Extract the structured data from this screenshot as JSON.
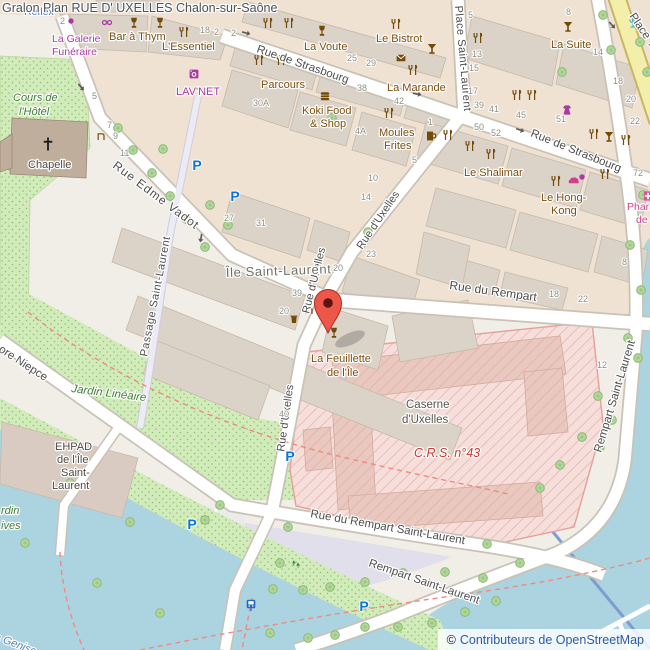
{
  "header": {
    "title": "Gralon Plan RUE D' UXELLES Chalon-sur-Saône"
  },
  "attribution": {
    "copyright": "©",
    "text": "Contributeurs de OpenStreetMap"
  },
  "colors": {
    "water": "#abd4e0",
    "park_green": "#d2ebbb",
    "military_fill": "#f6dedb",
    "military_border": "#e5a09a",
    "building": "#dbd2c8",
    "primary_road": "#f4eeab",
    "pedestrian_area": "#e0dfeb",
    "marker": "#ed574a",
    "parking_blue": "#0d74d6",
    "poi_brown": "#7a4e0e",
    "poi_purple": "#ab39a4",
    "attribution_blue": "#2d59a8"
  },
  "map": {
    "marker": {
      "x": 328,
      "y": 303,
      "color": "#ed574a"
    },
    "labels": [
      {
        "t": "Rue de Strasbourg",
        "x": 256,
        "y": 52,
        "r": 19,
        "c": "st"
      },
      {
        "t": "Rue de Strasbourg",
        "x": 530,
        "y": 136,
        "r": 22,
        "c": "st"
      },
      {
        "t": "Rue du Rempart",
        "x": 449,
        "y": 289,
        "r": 8,
        "c": "st",
        "fs": 12
      },
      {
        "t": "Rue du Rempart Saint-Laurent",
        "x": 310,
        "y": 517,
        "r": 10,
        "c": "st"
      },
      {
        "t": "Rempart Saint-Laurent",
        "x": 368,
        "y": 566,
        "r": 19,
        "c": "st"
      },
      {
        "t": "Rempart Saint-Laurent",
        "x": 601,
        "y": 453,
        "r": -73,
        "c": "st"
      },
      {
        "t": "Rue d'Uxelles",
        "x": 362,
        "y": 250,
        "r": -56,
        "c": "st",
        "fs": 11
      },
      {
        "t": "Rue d'Uxelles",
        "x": 309,
        "y": 314,
        "r": -76,
        "c": "st",
        "fs": 11
      },
      {
        "t": "Rue d'Uxelles",
        "x": 284,
        "y": 452,
        "r": -82,
        "c": "st",
        "fs": 11
      },
      {
        "t": "Rue Edme Vadot",
        "x": 112,
        "y": 167,
        "r": 37,
        "c": "st",
        "fs": 12,
        "ls": 1
      },
      {
        "t": "Passage Saint-Laurent",
        "x": 147,
        "y": 357,
        "r": -79,
        "c": "st",
        "fs": 11,
        "ls": 0.5
      },
      {
        "t": "Place Saint-Laurent",
        "x": 455,
        "y": 6,
        "r": 85,
        "c": "st",
        "fs": 11,
        "ls": 0.5
      },
      {
        "t": "Place Thev",
        "x": 629,
        "y": 16,
        "r": 56,
        "c": "st",
        "fs": 11.5
      },
      {
        "t": "ore Niepce",
        "x": -2,
        "y": 351,
        "r": 33,
        "c": "st",
        "fs": 11.5
      },
      {
        "t": "Île Saint-Laurent",
        "x": 226,
        "y": 277,
        "r": -2,
        "c": "pl"
      },
      {
        "t": "Cours de",
        "x": 13,
        "y": 101,
        "c": "pk"
      },
      {
        "t": "l'Hôtel",
        "x": 19,
        "y": 115,
        "c": "pk"
      },
      {
        "t": "Jardin Linéaire",
        "x": 71,
        "y": 392,
        "r": 7,
        "c": "pk",
        "fs": 11.5
      },
      {
        "t": "rdin",
        "x": 1,
        "y": 514,
        "c": "pk"
      },
      {
        "t": "ives",
        "x": 1,
        "y": 529,
        "c": "pk"
      },
      {
        "t": "La Genise",
        "x": -12,
        "y": 637,
        "r": 21,
        "c": "wt"
      },
      {
        "t": "Reflex",
        "x": 24,
        "y": 15,
        "c": "bl"
      },
      {
        "t": "La Galerie",
        "x": 52,
        "y": 42,
        "c": "pu"
      },
      {
        "t": "Funéraire",
        "x": 52,
        "y": 55,
        "c": "pu"
      },
      {
        "t": "LAV'NET",
        "x": 176,
        "y": 95,
        "c": "pu",
        "fs": 11
      },
      {
        "t": "Bar à Thym",
        "x": 109,
        "y": 40,
        "c": "br",
        "fs": 11
      },
      {
        "t": "L'Essentiel",
        "x": 162,
        "y": 50,
        "c": "br",
        "fs": 11
      },
      {
        "t": "La Voute",
        "x": 304,
        "y": 50,
        "c": "br",
        "fs": 11
      },
      {
        "t": "Le Bistrot",
        "x": 376,
        "y": 42,
        "c": "br",
        "fs": 11
      },
      {
        "t": "Parcours",
        "x": 261,
        "y": 88,
        "c": "br",
        "fs": 11
      },
      {
        "t": "La Marande",
        "x": 387,
        "y": 91,
        "c": "br",
        "fs": 11
      },
      {
        "t": "Koki Food",
        "x": 302,
        "y": 114,
        "c": "br",
        "fs": 11
      },
      {
        "t": "& Shop",
        "x": 310,
        "y": 127,
        "c": "br",
        "fs": 11
      },
      {
        "t": "Moules",
        "x": 379,
        "y": 136,
        "c": "br",
        "fs": 11
      },
      {
        "t": "Frites",
        "x": 384,
        "y": 149,
        "c": "br",
        "fs": 11
      },
      {
        "t": "Le Shalimar",
        "x": 464,
        "y": 176,
        "c": "br",
        "fs": 11
      },
      {
        "t": "Le Hong-",
        "x": 541,
        "y": 201,
        "c": "br",
        "fs": 11
      },
      {
        "t": "Kong",
        "x": 551,
        "y": 214,
        "c": "br",
        "fs": 11
      },
      {
        "t": "La Suite",
        "x": 551,
        "y": 48,
        "c": "br",
        "fs": 11
      },
      {
        "t": "La Feuillette",
        "x": 311,
        "y": 362,
        "c": "br",
        "fs": 11
      },
      {
        "t": "de l'Île",
        "x": 327,
        "y": 376,
        "c": "br",
        "fs": 11
      },
      {
        "t": "Pharm",
        "x": 627,
        "y": 210,
        "c": "ph"
      },
      {
        "t": "de",
        "x": 636,
        "y": 223,
        "c": "ph"
      },
      {
        "t": "Caserne",
        "x": 406,
        "y": 408,
        "c": "ca",
        "fs": 11.5
      },
      {
        "t": "d'Uxelles",
        "x": 402,
        "y": 423,
        "c": "ca",
        "fs": 11.5
      },
      {
        "t": "C.R.S. n°43",
        "x": 414,
        "y": 457,
        "c": "rd"
      },
      {
        "t": "Chapelle",
        "x": 28,
        "y": 168,
        "c": "bd"
      },
      {
        "t": "EHPAD",
        "x": 55,
        "y": 450,
        "c": "bd"
      },
      {
        "t": "de l'Île",
        "x": 57,
        "y": 463,
        "c": "bd"
      },
      {
        "t": "Saint-",
        "x": 61,
        "y": 476,
        "c": "bd"
      },
      {
        "t": "Laurent",
        "x": 52,
        "y": 489,
        "c": "bd"
      },
      {
        "t": "2",
        "x": 60,
        "y": 24,
        "c": "num"
      },
      {
        "t": "18",
        "x": 200,
        "y": 33,
        "c": "num"
      },
      {
        "t": "2",
        "x": 214,
        "y": 35,
        "c": "num"
      },
      {
        "t": "2",
        "x": 231,
        "y": 36,
        "c": "num"
      },
      {
        "t": "5",
        "x": 92,
        "y": 99,
        "c": "num"
      },
      {
        "t": "7",
        "x": 107,
        "y": 128,
        "c": "num"
      },
      {
        "t": "9",
        "x": 113,
        "y": 139,
        "c": "num"
      },
      {
        "t": "11",
        "x": 120,
        "y": 156,
        "c": "num"
      },
      {
        "t": "30A",
        "x": 253,
        "y": 106,
        "c": "num"
      },
      {
        "t": "25",
        "x": 347,
        "y": 61,
        "c": "num"
      },
      {
        "t": "29",
        "x": 366,
        "y": 66,
        "c": "num"
      },
      {
        "t": "38",
        "x": 357,
        "y": 91,
        "c": "num"
      },
      {
        "t": "42",
        "x": 394,
        "y": 104,
        "c": "num"
      },
      {
        "t": "4A",
        "x": 355,
        "y": 134,
        "c": "num"
      },
      {
        "t": "5",
        "x": 412,
        "y": 163,
        "c": "num"
      },
      {
        "t": "10",
        "x": 368,
        "y": 181,
        "c": "num"
      },
      {
        "t": "14",
        "x": 361,
        "y": 200,
        "c": "num"
      },
      {
        "t": "5",
        "x": 468,
        "y": 18,
        "c": "num"
      },
      {
        "t": "13",
        "x": 472,
        "y": 57,
        "c": "num"
      },
      {
        "t": "15",
        "x": 469,
        "y": 71,
        "c": "num"
      },
      {
        "t": "17",
        "x": 468,
        "y": 94,
        "c": "num"
      },
      {
        "t": "39",
        "x": 474,
        "y": 108,
        "c": "num"
      },
      {
        "t": "41",
        "x": 489,
        "y": 112,
        "c": "num"
      },
      {
        "t": "45",
        "x": 516,
        "y": 118,
        "c": "num"
      },
      {
        "t": "1",
        "x": 428,
        "y": 125,
        "c": "num"
      },
      {
        "t": "50",
        "x": 474,
        "y": 130,
        "c": "num"
      },
      {
        "t": "52",
        "x": 491,
        "y": 136,
        "c": "num"
      },
      {
        "t": "51",
        "x": 556,
        "y": 122,
        "c": "num"
      },
      {
        "t": "22",
        "x": 630,
        "y": 124,
        "c": "num"
      },
      {
        "t": "8",
        "x": 566,
        "y": 15,
        "c": "num"
      },
      {
        "t": "14",
        "x": 593,
        "y": 55,
        "c": "num"
      },
      {
        "t": "18",
        "x": 613,
        "y": 84,
        "c": "num"
      },
      {
        "t": "20",
        "x": 626,
        "y": 102,
        "c": "num"
      },
      {
        "t": "72",
        "x": 633,
        "y": 176,
        "c": "num"
      },
      {
        "t": "27",
        "x": 224,
        "y": 221,
        "c": "num"
      },
      {
        "t": "31",
        "x": 256,
        "y": 226,
        "c": "num"
      },
      {
        "t": "20",
        "x": 333,
        "y": 271,
        "c": "num"
      },
      {
        "t": "23",
        "x": 366,
        "y": 257,
        "c": "num"
      },
      {
        "t": "39",
        "x": 292,
        "y": 296,
        "c": "num"
      },
      {
        "t": "20",
        "x": 279,
        "y": 314,
        "c": "num"
      },
      {
        "t": "40",
        "x": 279,
        "y": 417,
        "c": "num"
      },
      {
        "t": "18",
        "x": 549,
        "y": 297,
        "c": "num"
      },
      {
        "t": "22",
        "x": 578,
        "y": 302,
        "c": "num"
      },
      {
        "t": "8",
        "x": 622,
        "y": 265,
        "c": "num"
      },
      {
        "t": "12",
        "x": 597,
        "y": 368,
        "c": "num"
      }
    ],
    "icons": [
      {
        "k": "wine",
        "x": 134,
        "y": 23
      },
      {
        "k": "wine",
        "x": 160,
        "y": 23
      },
      {
        "k": "rest",
        "x": 184,
        "y": 32
      },
      {
        "k": "rest",
        "x": 268,
        "y": 23
      },
      {
        "k": "rest",
        "x": 289,
        "y": 23
      },
      {
        "k": "wine",
        "x": 322,
        "y": 31
      },
      {
        "k": "rest",
        "x": 396,
        "y": 24
      },
      {
        "k": "post",
        "x": 401,
        "y": 58
      },
      {
        "k": "cocktail",
        "x": 432,
        "y": 49
      },
      {
        "k": "rest",
        "x": 413,
        "y": 70
      },
      {
        "k": "rest",
        "x": 259,
        "y": 60
      },
      {
        "k": "rest",
        "x": 281,
        "y": 60
      },
      {
        "k": "burger",
        "x": 325,
        "y": 96
      },
      {
        "k": "dot",
        "x": 71,
        "y": 21
      },
      {
        "k": "glasses",
        "x": 107,
        "y": 22
      },
      {
        "k": "laundry",
        "x": 194,
        "y": 74
      },
      {
        "k": "tap",
        "x": 101,
        "y": 136
      },
      {
        "k": "rest",
        "x": 389,
        "y": 113
      },
      {
        "k": "pub",
        "x": 431,
        "y": 136
      },
      {
        "k": "rest",
        "x": 448,
        "y": 135
      },
      {
        "k": "rest",
        "x": 478,
        "y": 38
      },
      {
        "k": "rest",
        "x": 517,
        "y": 95
      },
      {
        "k": "rest",
        "x": 532,
        "y": 95
      },
      {
        "k": "cocktail",
        "x": 568,
        "y": 27
      },
      {
        "k": "clothes",
        "x": 567,
        "y": 110
      },
      {
        "k": "rest",
        "x": 470,
        "y": 146
      },
      {
        "k": "rest",
        "x": 491,
        "y": 154
      },
      {
        "k": "rest",
        "x": 556,
        "y": 181
      },
      {
        "k": "bakery",
        "x": 574,
        "y": 181
      },
      {
        "k": "rest",
        "x": 594,
        "y": 134
      },
      {
        "k": "cocktail",
        "x": 609,
        "y": 137
      },
      {
        "k": "rest",
        "x": 626,
        "y": 140
      },
      {
        "k": "rest",
        "x": 605,
        "y": 174
      },
      {
        "k": "dot",
        "x": 582,
        "y": 177
      },
      {
        "k": "pharmacy",
        "x": 648,
        "y": 196
      },
      {
        "k": "fountain-blue",
        "x": 633,
        "y": 23
      },
      {
        "k": "cross",
        "x": 48,
        "y": 144
      },
      {
        "k": "tap",
        "x": 309,
        "y": 310
      },
      {
        "k": "waste",
        "x": 294,
        "y": 319
      },
      {
        "k": "wine",
        "x": 334,
        "y": 333
      },
      {
        "k": "parking",
        "x": 197,
        "y": 165
      },
      {
        "k": "parking",
        "x": 235,
        "y": 196
      },
      {
        "k": "parking",
        "x": 290,
        "y": 456
      },
      {
        "k": "parking",
        "x": 192,
        "y": 524
      },
      {
        "k": "parking",
        "x": 364,
        "y": 606
      },
      {
        "k": "bus",
        "x": 251,
        "y": 604
      },
      {
        "k": "plant",
        "x": 296,
        "y": 564
      },
      {
        "k": "arrow",
        "x": 81,
        "y": 87,
        "r": 50
      },
      {
        "k": "arrow",
        "x": 246,
        "y": 33,
        "r": 15
      },
      {
        "k": "arrow",
        "x": 417,
        "y": 94,
        "r": 10
      },
      {
        "k": "arrow",
        "x": 520,
        "y": 130,
        "r": 20
      },
      {
        "k": "arrow",
        "x": 612,
        "y": 25,
        "r": 48
      },
      {
        "k": "arrow",
        "x": 201,
        "y": 238,
        "r": 100
      }
    ],
    "trees": [
      [
        118,
        128
      ],
      [
        133,
        150
      ],
      [
        152,
        173
      ],
      [
        170,
        196
      ],
      [
        186,
        219
      ],
      [
        205,
        247
      ],
      [
        163,
        149
      ],
      [
        210,
        205
      ],
      [
        228,
        225
      ],
      [
        332,
        118
      ],
      [
        368,
        232
      ],
      [
        562,
        72
      ],
      [
        603,
        15
      ],
      [
        640,
        42
      ],
      [
        647,
        72
      ],
      [
        611,
        50
      ],
      [
        643,
        195
      ],
      [
        630,
        245
      ],
      [
        641,
        290
      ],
      [
        628,
        338
      ],
      [
        638,
        358
      ],
      [
        598,
        396
      ],
      [
        612,
        420
      ],
      [
        582,
        437
      ],
      [
        600,
        447
      ],
      [
        560,
        465
      ],
      [
        540,
        488
      ],
      [
        487,
        544
      ],
      [
        70,
        483
      ],
      [
        25,
        543
      ],
      [
        97,
        583
      ],
      [
        160,
        613
      ],
      [
        130,
        522
      ],
      [
        205,
        520
      ],
      [
        220,
        505
      ],
      [
        288,
        527
      ],
      [
        280,
        563
      ],
      [
        273,
        589
      ],
      [
        303,
        590
      ],
      [
        330,
        587
      ],
      [
        365,
        582
      ],
      [
        403,
        573
      ],
      [
        445,
        572
      ],
      [
        483,
        578
      ],
      [
        520,
        563
      ],
      [
        270,
        633
      ],
      [
        308,
        638
      ],
      [
        335,
        635
      ],
      [
        365,
        627
      ],
      [
        398,
        627
      ],
      [
        432,
        623
      ],
      [
        465,
        612
      ],
      [
        496,
        601
      ]
    ]
  }
}
